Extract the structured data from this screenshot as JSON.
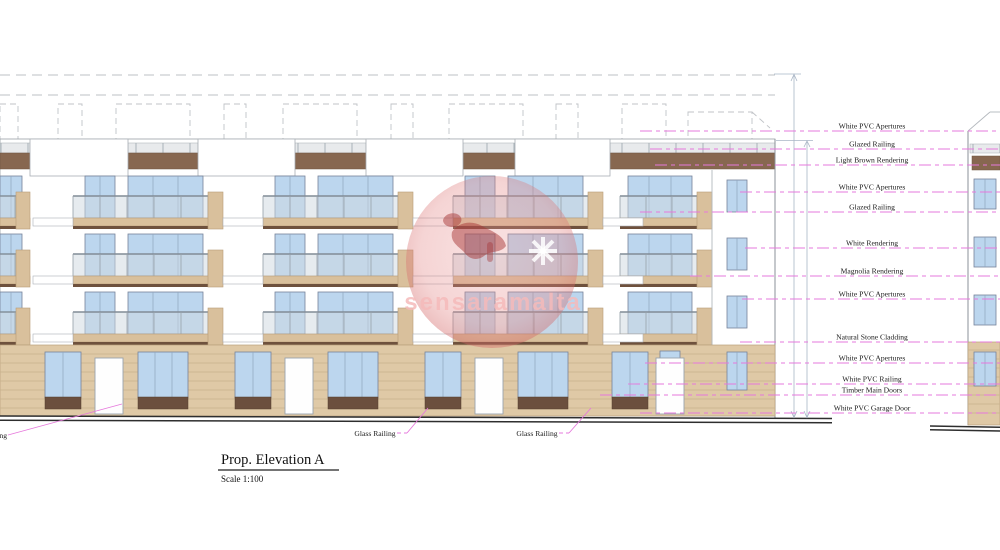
{
  "drawing": {
    "title": "Prop. Elevation A",
    "scale": "Scale 1:100",
    "watermark": "sensaramalta",
    "labels": {
      "right": [
        "White PVC Apertures",
        "Glazed Railing",
        "Light Brown Rendering",
        "White PVC Apertures",
        "Glazed Railing",
        "White Rendering",
        "Magnolia Rendering",
        "White PVC Apertures",
        "Natural Stone Cladding",
        "White PVC Apertures",
        "White PVC Railing",
        "Timber Main Doors",
        "White PVC Garage Door"
      ],
      "glass_railing": "Glass Railing"
    },
    "colors": {
      "leader_pink": "#e678dc",
      "stone_tan": "#dfc9a6",
      "render_brown": "#876750",
      "window_blue": "#bcd6ee",
      "railing_panel_brown": "#6b4f3e",
      "watermark_red": "#d98080"
    }
  }
}
